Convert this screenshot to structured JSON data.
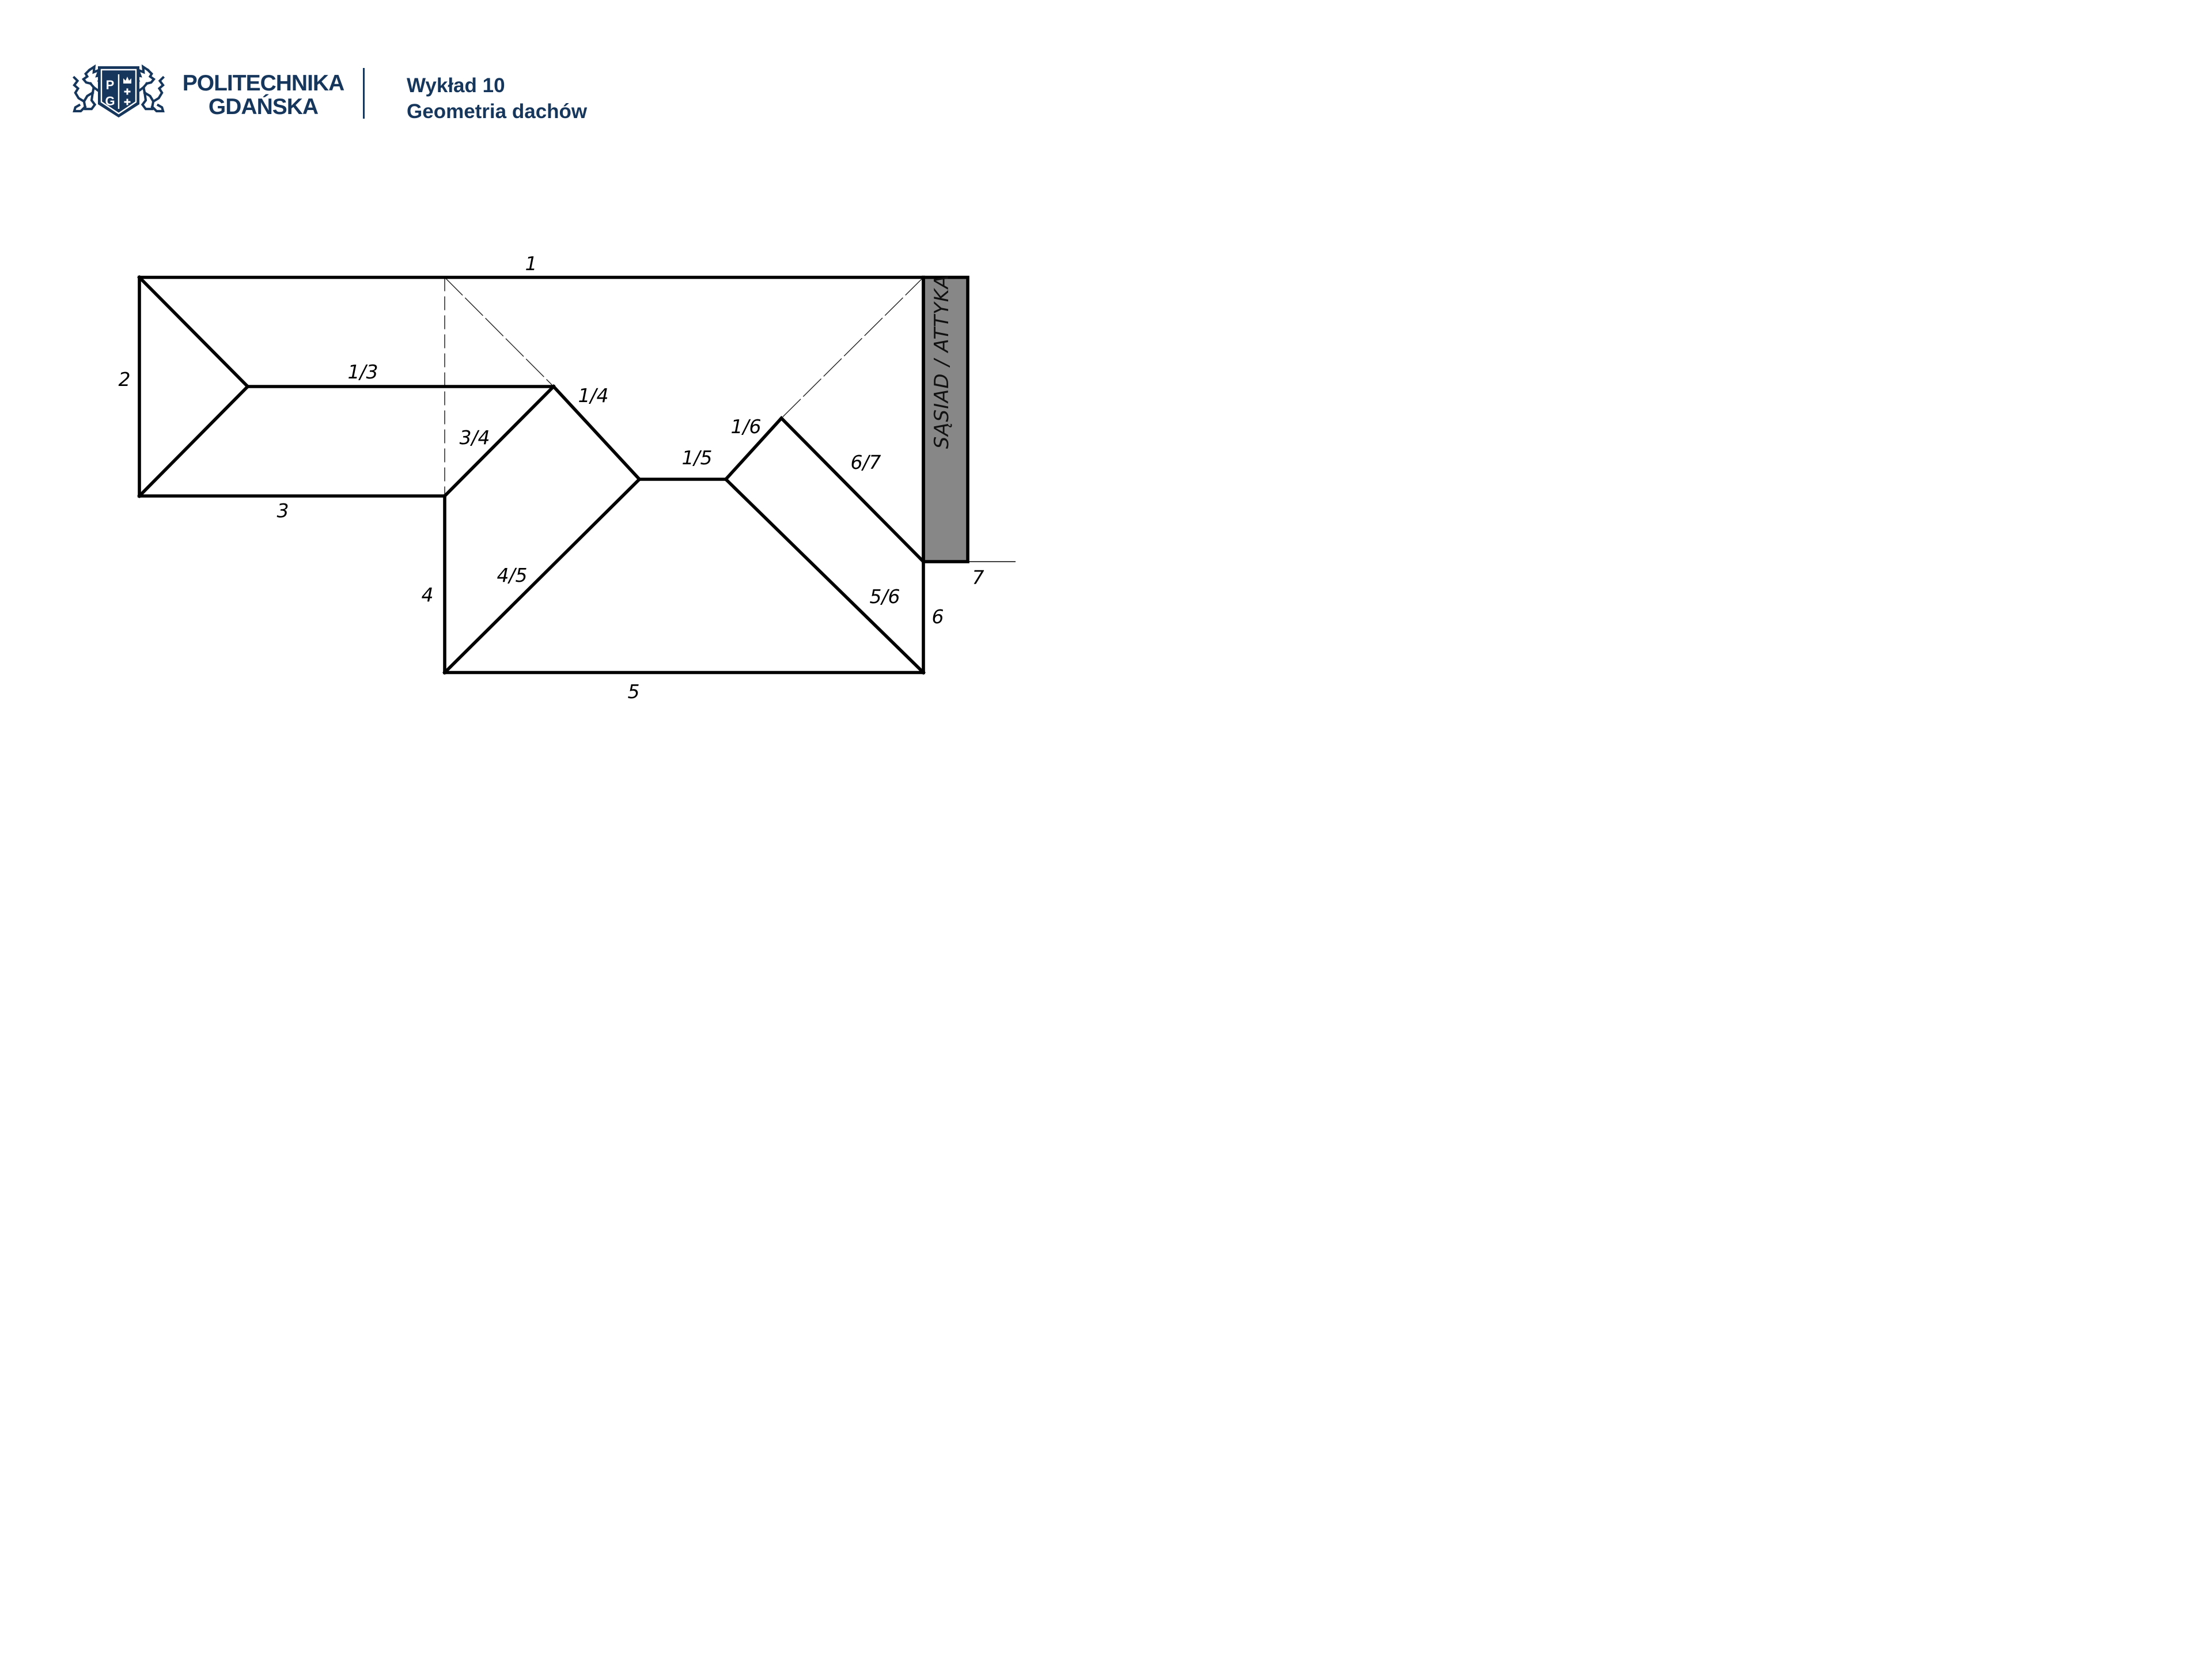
{
  "header": {
    "university_line1": "POLITECHNIKA",
    "university_line2": "GDAŃSKA",
    "lecture_number": "Wykład 10",
    "lecture_topic": "Geometria dachów",
    "crest": {
      "letter_p": "P",
      "letter_g": "G"
    }
  },
  "diagram": {
    "band": {
      "label": "SĄSIAD / ATTYKA",
      "fill": "#878787"
    },
    "eave_labels": {
      "e1": "1",
      "e2": "2",
      "e3": "3",
      "e4": "4",
      "e5": "5",
      "e6": "6",
      "e7": "7"
    },
    "roof_labels": {
      "r13": "1/3",
      "r34": "3/4",
      "r14": "1/4",
      "r45": "4/5",
      "r15": "1/5",
      "r16": "1/6",
      "r56": "5/6",
      "r67": "6/7"
    },
    "colors": {
      "line": "#000000",
      "brand_navy": "#16365C",
      "band_gray": "#878787"
    }
  }
}
